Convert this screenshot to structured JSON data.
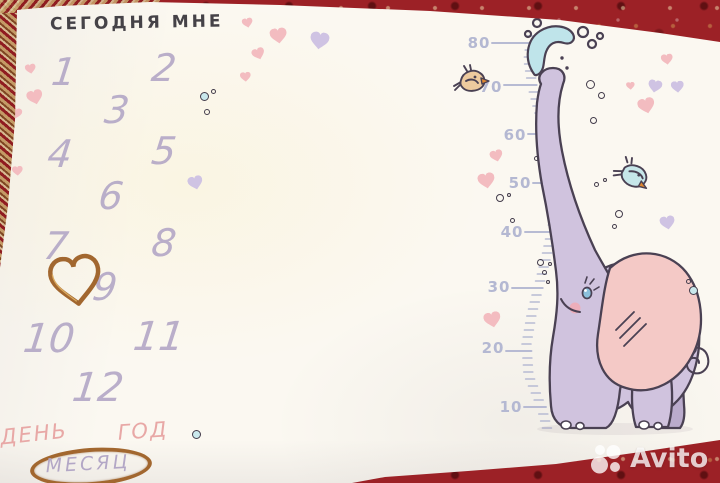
{
  "blanket": {
    "title": "СЕГОДНЯ МНЕ",
    "months": [
      "1",
      "2",
      "3",
      "4",
      "5",
      "6",
      "7",
      "8",
      "9",
      "10",
      "11",
      "12"
    ],
    "words": {
      "day": "ДЕНЬ",
      "year": "ГОД",
      "month": "МЕСЯЦ"
    }
  },
  "growth_ruler": {
    "unit_labels": [
      "80",
      "70",
      "60",
      "50",
      "40",
      "30",
      "20",
      "10"
    ]
  },
  "watermark": {
    "brand": "Avito"
  },
  "colors": {
    "carpet_red": "#9c2126",
    "blanket_cream": "#fbf8f1",
    "title_text": "#454247",
    "number_lavender": "#b3a7c6",
    "ruler_blue": "#b4b8d2",
    "pink_heart": "#f3bcc0",
    "purple_heart": "#cfc3e3",
    "word_pink": "#e8a8a6",
    "gold": "#a2672f",
    "outline_dark": "#4a4153",
    "elephant_body": "#d0c3de",
    "elephant_leg_far": "#baabcc",
    "elephant_ear": "#f4c9c6",
    "teal_bubble": "#c9e8ec",
    "splash_teal": "#bfe4ea",
    "bird_tan": "#edca9e",
    "bird_teal": "#c6e6e9",
    "beak_orange": "#e0872f",
    "watermark_white": "rgba(255,255,255,0.78)"
  },
  "icons": {
    "hearts": "heart-icon",
    "bubbles": "bubble-icon",
    "elephant": "elephant-illustration",
    "water": "water-splash-icon",
    "birds": "bird-icon",
    "gold_heart": "gold-wire-heart-icon",
    "gold_oval": "gold-oval-frame"
  }
}
